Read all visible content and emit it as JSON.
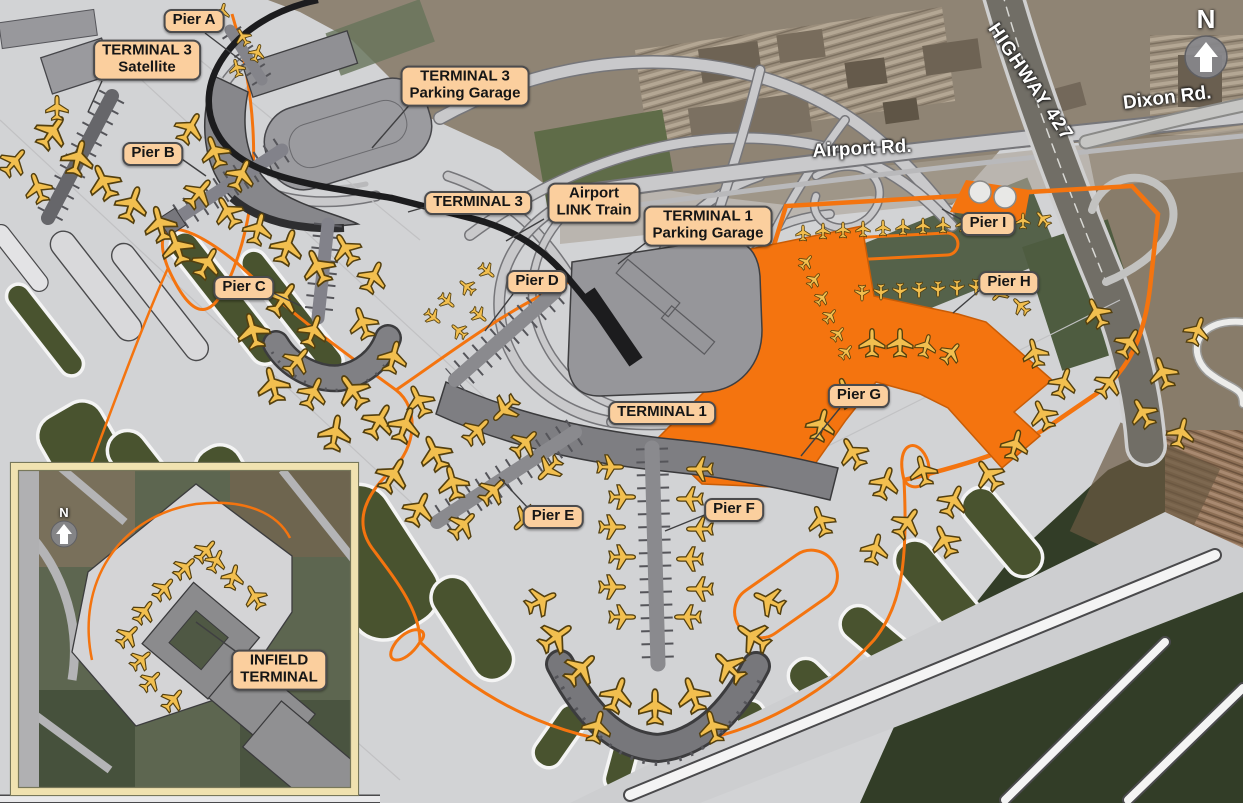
{
  "labels": {
    "pier_a": "Pier A",
    "terminal_3_satellite": "TERMINAL 3\nSatellite",
    "terminal_3_parking": "TERMINAL 3\nParking Garage",
    "pier_b": "Pier B",
    "terminal_3": "TERMINAL 3",
    "airport_link_train": "Airport\nLINK Train",
    "terminal_1_parking": "TERMINAL 1\nParking Garage",
    "pier_i": "Pier I",
    "pier_c": "Pier C",
    "pier_d": "Pier D",
    "pier_h": "Pier H",
    "pier_g": "Pier G",
    "terminal_1": "TERMINAL 1",
    "pier_e": "Pier E",
    "pier_f": "Pier F",
    "infield_terminal": "INFIELD\nTERMINAL"
  },
  "roads": {
    "airport_rd": "Airport Rd.",
    "highway_427": "HIGHWAY 427",
    "dixon_rd": "Dixon Rd."
  },
  "compass": {
    "north": "N"
  },
  "compass_inset": {
    "north": "N"
  },
  "colors": {
    "label_bg": "#FBCF9E",
    "label_border": "#4B4B4D",
    "road_orange": "#F4740F",
    "highlight_orange": "#F4740F",
    "plane_yellow": "#F2BF4F",
    "apron_gray": "#D2D3D5",
    "terminal_gray": "#8A8A8E",
    "runway_white": "#F4F4F4",
    "street_text": "#FFFFFF",
    "inset_frame": "#F0E2B0"
  },
  "icons": {
    "airplane": "airplane-silhouette",
    "north_arrow": "up-arrow-in-gray-circle"
  },
  "decor": {
    "main_planes": [
      [
        52,
        132,
        35,
        1
      ],
      [
        78,
        158,
        15,
        1
      ],
      [
        104,
        182,
        -25,
        1
      ],
      [
        132,
        204,
        20,
        1
      ],
      [
        160,
        224,
        -15,
        1
      ],
      [
        57,
        108,
        0,
        0.7
      ],
      [
        14,
        162,
        40,
        0.85
      ],
      [
        38,
        188,
        -20,
        0.85
      ],
      [
        190,
        128,
        30,
        0.9
      ],
      [
        215,
        152,
        -20,
        0.9
      ],
      [
        241,
        175,
        25,
        0.9
      ],
      [
        199,
        193,
        40,
        0.9
      ],
      [
        228,
        212,
        -30,
        0.9
      ],
      [
        258,
        229,
        15,
        0.9
      ],
      [
        177,
        247,
        -20,
        1
      ],
      [
        207,
        263,
        30,
        0.9
      ],
      [
        243,
        37,
        -30,
        0.5
      ],
      [
        257,
        53,
        20,
        0.5
      ],
      [
        237,
        68,
        -15,
        0.5
      ],
      [
        222,
        12,
        15,
        0.5
      ],
      [
        287,
        247,
        20,
        1
      ],
      [
        318,
        267,
        -25,
        1
      ],
      [
        283,
        299,
        35,
        1
      ],
      [
        253,
        331,
        -15,
        1
      ],
      [
        313,
        331,
        20,
        0.9
      ],
      [
        346,
        249,
        -30,
        0.9
      ],
      [
        373,
        277,
        25,
        0.9
      ],
      [
        363,
        323,
        -20,
        0.9
      ],
      [
        393,
        357,
        15,
        0.9
      ],
      [
        353,
        391,
        -35,
        1
      ],
      [
        313,
        393,
        25,
        0.9
      ],
      [
        273,
        385,
        -15,
        1
      ],
      [
        379,
        421,
        30,
        1
      ],
      [
        419,
        401,
        -25,
        0.9
      ],
      [
        335,
        433,
        10,
        1
      ],
      [
        297,
        361,
        40,
        0.85
      ],
      [
        447,
        301,
        130,
        0.5
      ],
      [
        467,
        287,
        -50,
        0.5
      ],
      [
        487,
        271,
        130,
        0.5
      ],
      [
        459,
        331,
        -50,
        0.5
      ],
      [
        479,
        315,
        130,
        0.5
      ],
      [
        433,
        317,
        130,
        0.5
      ],
      [
        405,
        425,
        20,
        1
      ],
      [
        435,
        453,
        -25,
        1
      ],
      [
        393,
        475,
        30,
        1
      ],
      [
        453,
        483,
        -15,
        0.95
      ],
      [
        419,
        509,
        25,
        0.95
      ],
      [
        477,
        431,
        45,
        0.85
      ],
      [
        505,
        409,
        -135,
        0.85
      ],
      [
        525,
        443,
        45,
        0.85
      ],
      [
        549,
        469,
        -135,
        0.8
      ],
      [
        493,
        491,
        45,
        0.85
      ],
      [
        525,
        519,
        -135,
        0.8
      ],
      [
        463,
        525,
        45,
        0.85
      ],
      [
        610,
        467,
        90,
        0.75
      ],
      [
        622,
        497,
        90,
        0.75
      ],
      [
        612,
        527,
        90,
        0.75
      ],
      [
        622,
        557,
        90,
        0.75
      ],
      [
        612,
        587,
        90,
        0.75
      ],
      [
        700,
        469,
        -90,
        0.75
      ],
      [
        690,
        499,
        -90,
        0.75
      ],
      [
        700,
        529,
        -90,
        0.75
      ],
      [
        690,
        559,
        -90,
        0.75
      ],
      [
        700,
        589,
        -90,
        0.75
      ],
      [
        622,
        617,
        90,
        0.75
      ],
      [
        688,
        617,
        -90,
        0.75
      ],
      [
        556,
        637,
        55,
        1
      ],
      [
        581,
        669,
        45,
        1
      ],
      [
        617,
        695,
        20,
        1
      ],
      [
        655,
        707,
        0,
        1
      ],
      [
        693,
        695,
        -20,
        1
      ],
      [
        729,
        667,
        -45,
        1
      ],
      [
        753,
        637,
        -55,
        1
      ],
      [
        541,
        601,
        65,
        0.9
      ],
      [
        769,
        601,
        -65,
        0.9
      ],
      [
        597,
        727,
        15,
        0.9
      ],
      [
        713,
        727,
        -15,
        0.9
      ],
      [
        803,
        233,
        0,
        0.45
      ],
      [
        823,
        231,
        0,
        0.45
      ],
      [
        843,
        230,
        0,
        0.45
      ],
      [
        863,
        229,
        0,
        0.45
      ],
      [
        883,
        228,
        0,
        0.45
      ],
      [
        903,
        227,
        0,
        0.45
      ],
      [
        923,
        226,
        0,
        0.45
      ],
      [
        943,
        225,
        0,
        0.45
      ],
      [
        963,
        224,
        0,
        0.45
      ],
      [
        983,
        223,
        0,
        0.45
      ],
      [
        1003,
        222,
        0,
        0.45
      ],
      [
        1023,
        221,
        0,
        0.45
      ],
      [
        1043,
        219,
        -40,
        0.5
      ],
      [
        806,
        262,
        40,
        0.45
      ],
      [
        814,
        280,
        40,
        0.45
      ],
      [
        822,
        298,
        40,
        0.45
      ],
      [
        830,
        316,
        40,
        0.45
      ],
      [
        838,
        334,
        40,
        0.45
      ],
      [
        846,
        352,
        40,
        0.45
      ],
      [
        862,
        293,
        180,
        0.45
      ],
      [
        881,
        292,
        180,
        0.45
      ],
      [
        900,
        291,
        180,
        0.45
      ],
      [
        919,
        290,
        180,
        0.45
      ],
      [
        938,
        289,
        180,
        0.45
      ],
      [
        957,
        288,
        180,
        0.45
      ],
      [
        976,
        287,
        180,
        0.45
      ],
      [
        1000,
        293,
        -135,
        0.55
      ],
      [
        1021,
        306,
        -45,
        0.55
      ],
      [
        872,
        343,
        0,
        0.8
      ],
      [
        900,
        343,
        0,
        0.8
      ],
      [
        926,
        346,
        15,
        0.65
      ],
      [
        951,
        353,
        40,
        0.65
      ],
      [
        846,
        393,
        -20,
        0.85
      ],
      [
        821,
        425,
        15,
        0.9
      ],
      [
        853,
        453,
        -30,
        0.9
      ],
      [
        885,
        483,
        20,
        0.9
      ],
      [
        923,
        471,
        -15,
        0.85
      ],
      [
        953,
        501,
        25,
        0.9
      ],
      [
        989,
        475,
        -35,
        0.9
      ],
      [
        1015,
        445,
        15,
        0.85
      ],
      [
        1043,
        415,
        -25,
        0.85
      ],
      [
        1063,
        383,
        20,
        0.85
      ],
      [
        1035,
        353,
        -15,
        0.8
      ],
      [
        907,
        523,
        35,
        0.9
      ],
      [
        945,
        541,
        -25,
        0.9
      ],
      [
        875,
        549,
        15,
        0.85
      ],
      [
        821,
        521,
        -20,
        0.85
      ],
      [
        1097,
        313,
        -25,
        0.85
      ],
      [
        1129,
        343,
        30,
        0.85
      ],
      [
        1163,
        373,
        -20,
        0.9
      ],
      [
        1109,
        383,
        35,
        0.85
      ],
      [
        1143,
        413,
        -30,
        0.85
      ],
      [
        1181,
        433,
        15,
        0.85
      ],
      [
        1197,
        331,
        20,
        0.8
      ]
    ],
    "inset_planes": [
      [
        206,
        551,
        40,
        0.7
      ],
      [
        185,
        568,
        45,
        0.7
      ],
      [
        164,
        589,
        40,
        0.7
      ],
      [
        144,
        612,
        35,
        0.7
      ],
      [
        128,
        636,
        45,
        0.7
      ],
      [
        141,
        660,
        50,
        0.65
      ],
      [
        151,
        681,
        45,
        0.65
      ],
      [
        173,
        700,
        40,
        0.7
      ],
      [
        216,
        561,
        25,
        0.65
      ],
      [
        233,
        577,
        15,
        0.7
      ],
      [
        255,
        597,
        -30,
        0.7
      ]
    ]
  }
}
